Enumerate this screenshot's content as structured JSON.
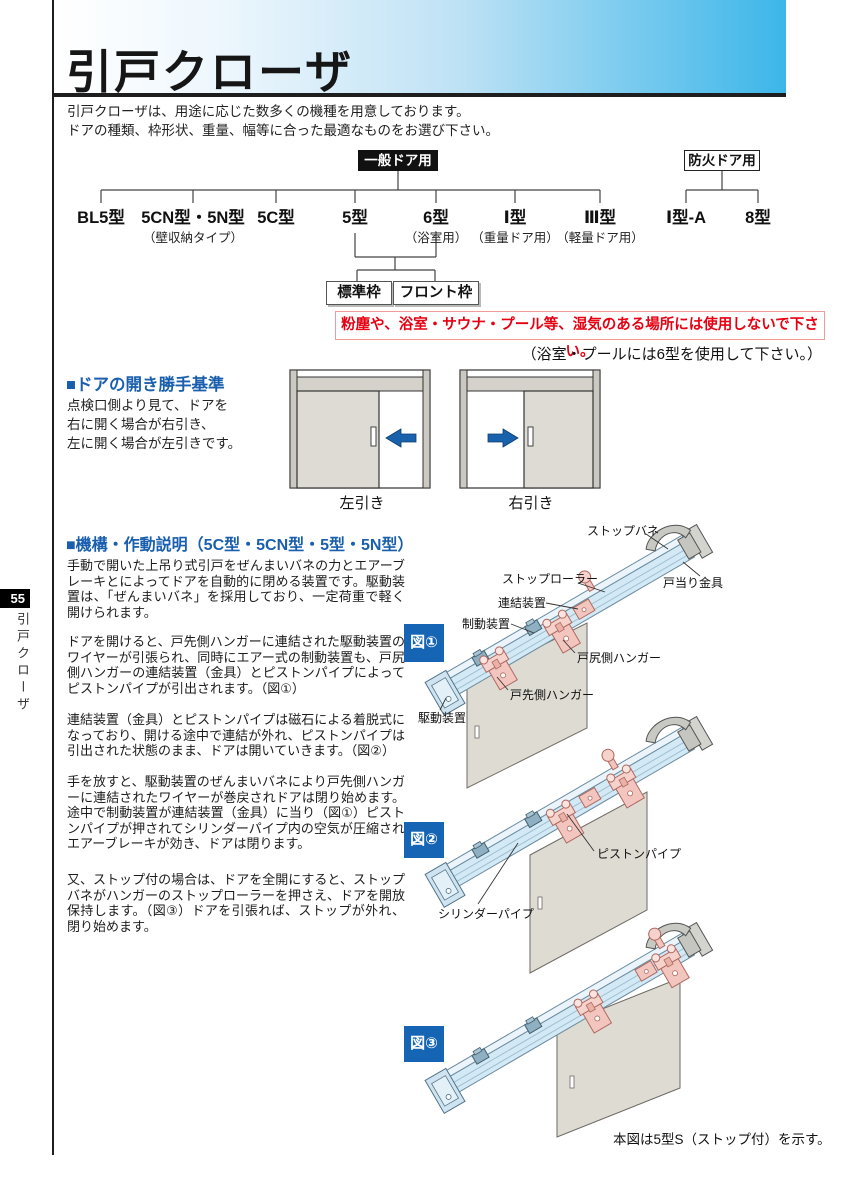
{
  "page": {
    "number": "55",
    "side_tab": "引戸クローザ"
  },
  "header": {
    "title": "引戸クローザ",
    "intro_line1": "引戸クローザは、用途に応じた数多くの機種を用意しております。",
    "intro_line2": "ドアの種類、枠形状、重量、幅等に合った最適なものをお選び下さい。"
  },
  "tree": {
    "general_label": "一般ドア用",
    "fire_label": "防火ドア用",
    "general_children": [
      {
        "label": "BL5型",
        "sub": ""
      },
      {
        "label": "5CN型・5N型",
        "sub": "（壁収納タイプ）"
      },
      {
        "label": "5C型",
        "sub": ""
      },
      {
        "label": "5型",
        "sub": ""
      },
      {
        "label": "6型",
        "sub": "（浴室用）"
      },
      {
        "label": "Ⅰ型",
        "sub": "（重量ドア用）"
      },
      {
        "label": "Ⅲ型",
        "sub": "（軽量ドア用）"
      }
    ],
    "fire_children": [
      {
        "label": "Ⅰ型-A",
        "sub": ""
      },
      {
        "label": "8型",
        "sub": ""
      }
    ],
    "frame_left": "標準枠",
    "frame_right": "フロント枠",
    "warning": "粉塵や、浴室・サウナ・プール等、湿気のある場所には使用しないで下さい。",
    "warning_sub": "（浴室・プールには6型を使用して下さい。）"
  },
  "direction": {
    "heading": "■ドアの開き勝手基準",
    "line1": "点検口側より見て、ドアを",
    "line2": "右に開く場合が右引き、",
    "line3": "左に開く場合が左引きです。",
    "left_caption": "左引き",
    "right_caption": "右引き"
  },
  "mechanism": {
    "heading": "■機構・作動説明（5C型・5CN型・5型・5N型）",
    "p1": "手動で開いた上吊り式引戸をぜんまいバネの力とエアーブレーキとによってドアを自動的に閉める装置です。駆動装置は、「ぜんまいバネ」を採用しており、一定荷重で軽く開けられます。",
    "p2": "ドアを開けると、戸先側ハンガーに連結された駆動装置のワイヤーが引張られ、同時にエアー式の制動装置も、戸尻側ハンガーの連結装置（金具）とピストンパイプによってピストンパイプが引出されます。（図①）",
    "p3": "連結装置（金具）とピストンパイプは磁石による着脱式になっており、開ける途中で連結が外れ、ピストンパイプは引出された状態のまま、ドアは開いていきます。（図②）",
    "p4": "手を放すと、駆動装置のぜんまいバネにより戸先側ハンガーに連結されたワイヤーが巻戻されドアは閉り始めます。途中で制動装置が連結装置（金具）に当り（図①）ピストンパイプが押されてシリンダーパイプ内の空気が圧縮されエアーブレーキが効き、ドアは閉ります。",
    "p5": "又、ストップ付の場合は、ドアを全開にすると、ストップバネがハンガーのストップローラーを押さえ、ドアを開放保持します。（図③）ドアを引張れば、ストップが外れ、閉り始めます。"
  },
  "figures": {
    "fig1_label": "図①",
    "fig2_label": "図②",
    "fig3_label": "図③",
    "fig1_callouts": {
      "stop_spring": "ストップバネ",
      "door_stop": "戸当り金具",
      "stop_roller": "ストップローラー",
      "coupling": "連結装置",
      "brake": "制動装置",
      "rear_hanger": "戸尻側ハンガー",
      "front_hanger": "戸先側ハンガー",
      "drive": "駆動装置"
    },
    "fig2_callouts": {
      "piston_pipe": "ピストンパイプ",
      "cylinder_pipe": "シリンダーパイプ"
    },
    "note": "本図は5型S（ストップ付）を示す。"
  },
  "colors": {
    "accent_blue": "#1a5fae",
    "header_blue": "#3cb6e9",
    "warning_red": "#e60012",
    "figure_label_blue": "#1565b4",
    "arrow_blue": "#1862ad"
  }
}
